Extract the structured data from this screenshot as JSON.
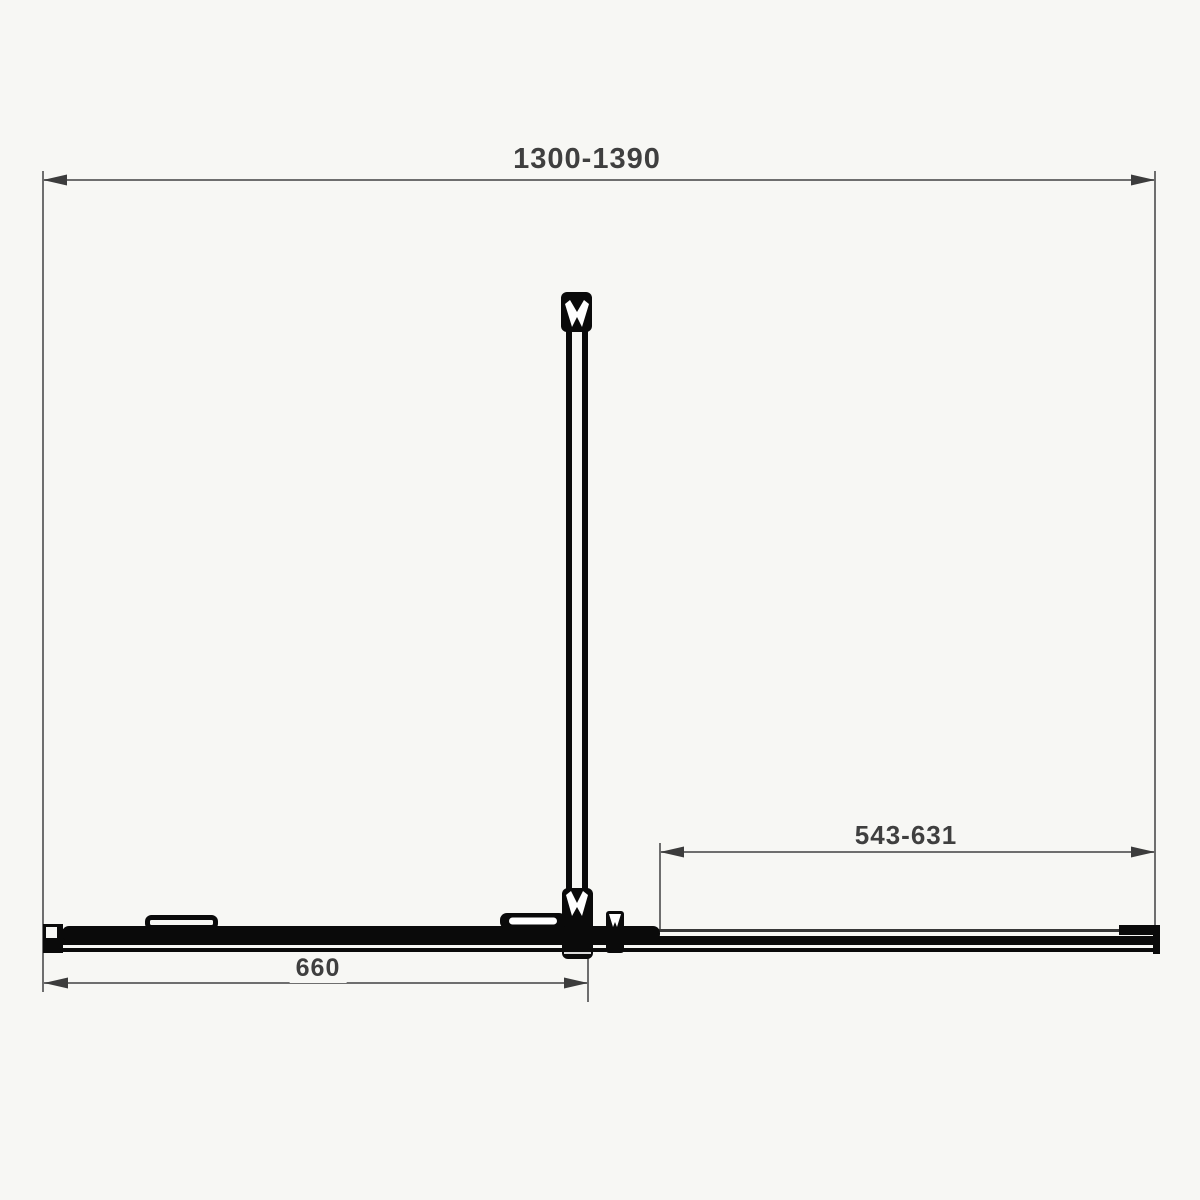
{
  "diagram": {
    "type": "technical-dimension-drawing",
    "subject": "sliding shower door enclosure, plan view",
    "dimensions": {
      "overall_width": {
        "label": "1300-1390",
        "position": "top"
      },
      "opening_width": {
        "label": "543-631",
        "position": "right-lower"
      },
      "door_width": {
        "label": "660",
        "position": "bottom-left"
      }
    },
    "colors": {
      "background": "#f7f7f4",
      "line": "#0a0a0a",
      "dimension_line": "#6e6e6e",
      "label_text": "#3f3f3f"
    }
  }
}
